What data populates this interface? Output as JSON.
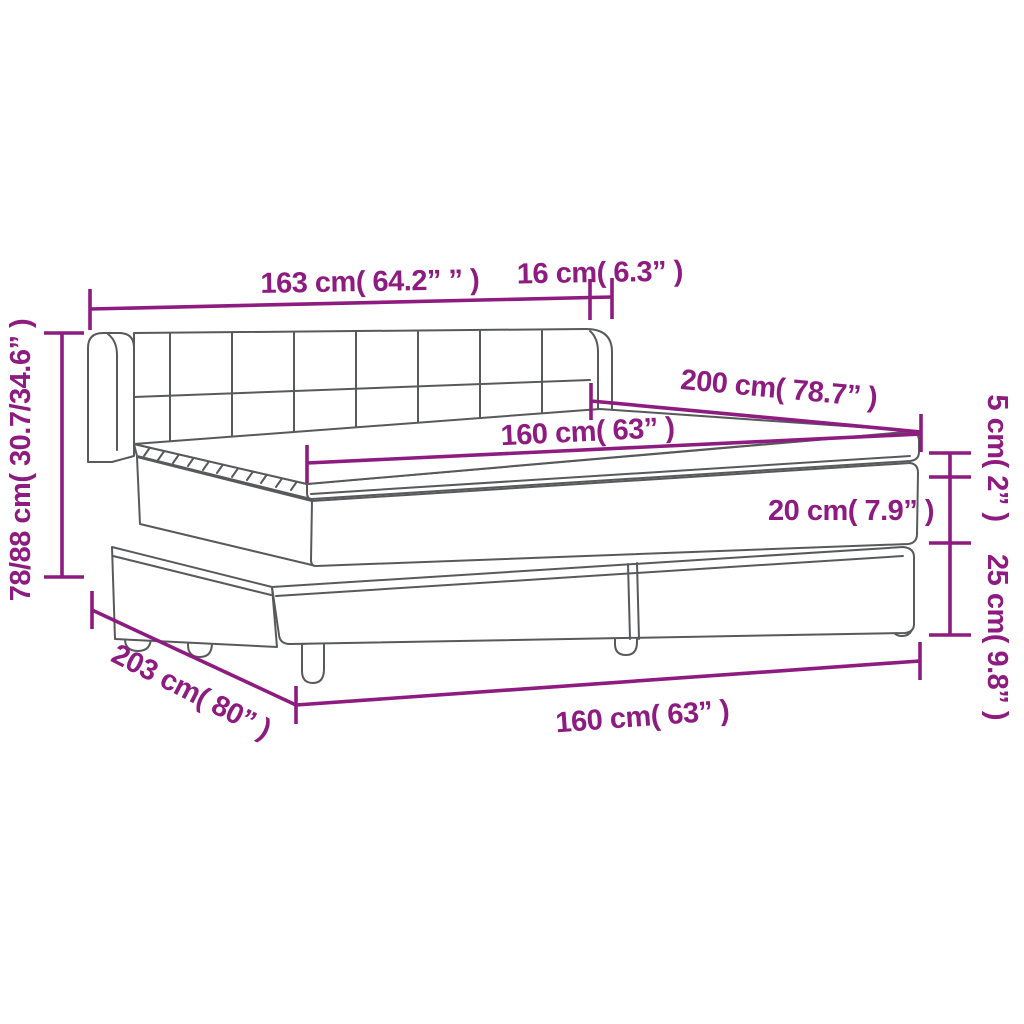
{
  "diagram": {
    "kind": "product-dimension-diagram",
    "subject": "box spring bed with headboard, mattress and topper",
    "colors": {
      "dimension_accent": "#8e1c80",
      "drawing_outline": "#58595b",
      "background": "#ffffff"
    },
    "labels": {
      "total_width": "163 cm( 64.2” ” )",
      "headboard_overhang": "16 cm( 6.3” )",
      "headboard_height": "78/88 cm( 30.7/34.6” )",
      "bed_length_top": "200 cm( 78.7” )",
      "mattress_width_top": "160 cm( 63” )",
      "topper_thickness": "5 cm( 2” )",
      "mattress_thickness": "20 cm( 7.9” )",
      "base_height": "25 cm( 9.8” )",
      "base_length": "203 cm( 80” )",
      "mattress_width_bottom": "160 cm( 63” )"
    }
  }
}
